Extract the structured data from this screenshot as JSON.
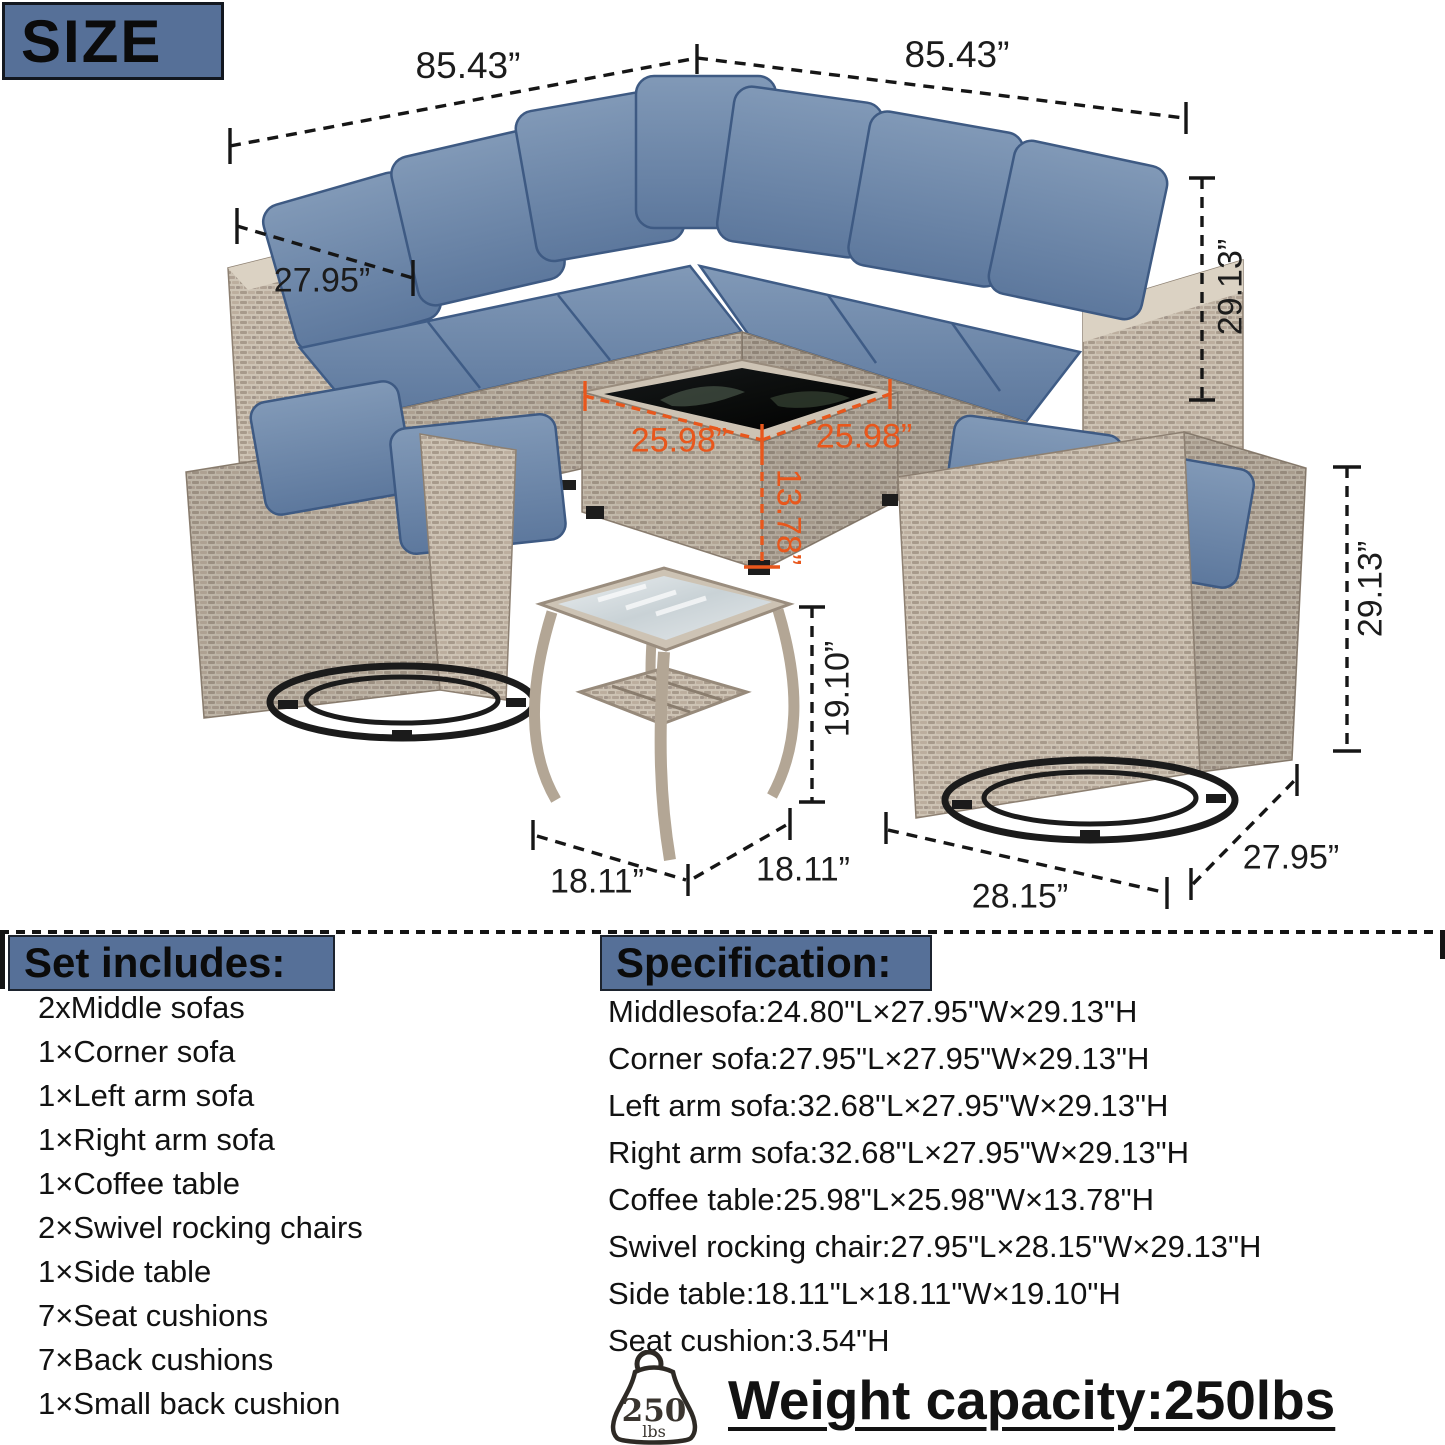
{
  "size_label": "SIZE",
  "colors": {
    "header_bg": "#567098",
    "dim_line_black": "#161616",
    "dim_line_orange": "#e8571c",
    "cushion_blue": "#66819f",
    "wicker_tan": "#c6bbac"
  },
  "dims": {
    "sofa_top_left": "85.43”",
    "sofa_top_right": "85.43”",
    "sofa_arm_depth": "27.95”",
    "sofa_height": "29.13”",
    "coffee_len_left": "25.98”",
    "coffee_len_right": "25.98”",
    "coffee_height": "13.78”",
    "side_table_height": "19.10”",
    "side_table_len_left": "18.11”",
    "side_table_len_right": "18.11”",
    "chair_width": "28.15”",
    "chair_depth": "27.95”",
    "chair_height": "29.13”"
  },
  "set_includes": {
    "title": "Set includes:",
    "items": [
      "2xMiddle sofas",
      "1×Corner sofa",
      "1×Left arm sofa",
      "1×Right arm sofa",
      "1×Coffee table",
      "2×Swivel rocking chairs",
      "1×Side table",
      "7×Seat cushions",
      "7×Back cushions",
      "1×Small back cushion"
    ]
  },
  "specification": {
    "title": "Specification:",
    "items": [
      "Middlesofa:24.80\"L×27.95\"W×29.13\"H",
      "Corner sofa:27.95\"L×27.95\"W×29.13\"H",
      "Left arm sofa:32.68\"L×27.95\"W×29.13\"H",
      "Right arm sofa:32.68\"L×27.95\"W×29.13\"H",
      "Coffee table:25.98\"L×25.98\"W×13.78\"H",
      "Swivel rocking chair:27.95\"L×28.15\"W×29.13\"H",
      "Side table:18.11\"L×18.11\"W×19.10\"H",
      "Seat cushion:3.54\"H"
    ]
  },
  "weight": {
    "badge_value": "250",
    "badge_unit": "lbs",
    "label": "Weight capacity:250lbs"
  }
}
